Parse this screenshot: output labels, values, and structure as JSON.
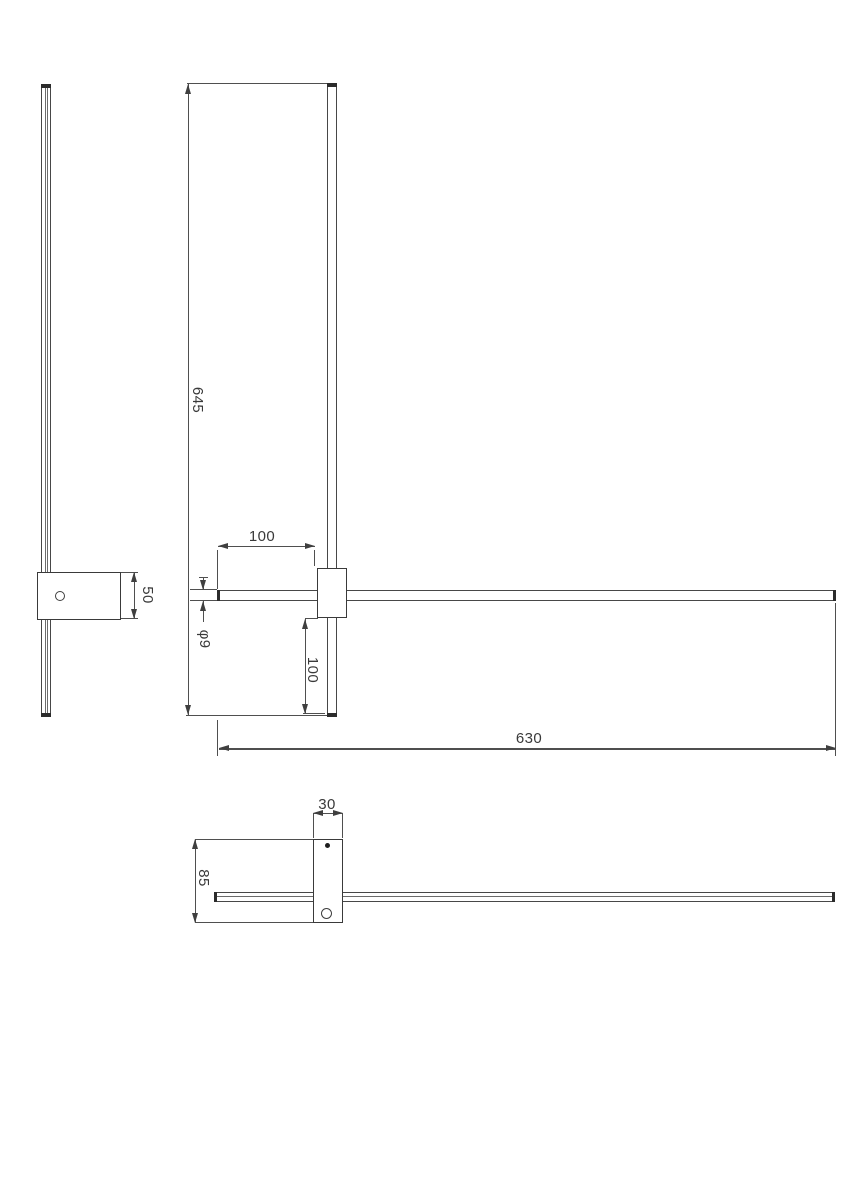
{
  "figure": {
    "kind": "technical-drawing",
    "subject": "linear wall lamp with mounting bracket, three orthographic views"
  },
  "colors": {
    "background": "#ffffff",
    "object_line": "#474747",
    "cap_fill": "#2b2b2b",
    "dimension_line": "#4f4f4f",
    "text": "#3a3a3a"
  },
  "views": {
    "side": {
      "bracket_height": "50"
    },
    "front": {
      "height": "645",
      "left_offset": "100",
      "tube_diameter": "φ9",
      "bottom_offset": "100",
      "length": "630"
    },
    "bottom": {
      "bracket_width": "30",
      "bracket_depth": "85"
    }
  }
}
